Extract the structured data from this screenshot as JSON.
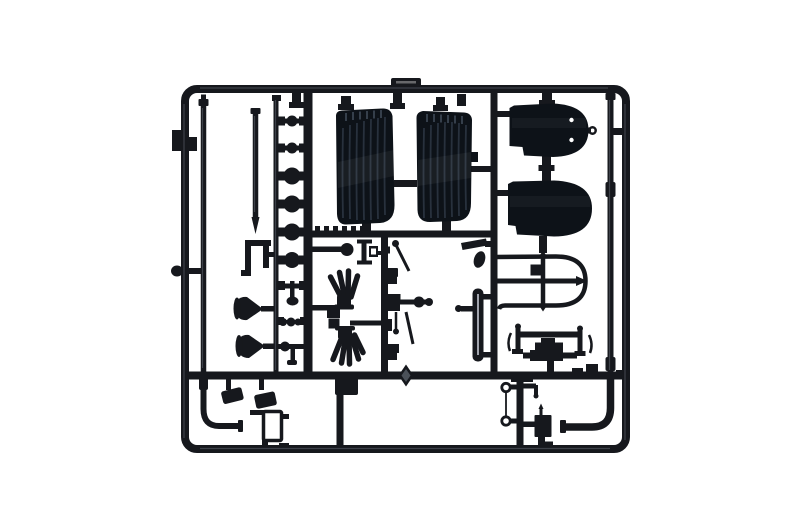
{
  "image": {
    "type": "product-photograph",
    "subject": "Injection-molded model kit sprue (parts tree) of black plastic parts on a white background",
    "orientation": "landscape",
    "background": "#ffffff"
  },
  "colors": {
    "plastic": "#16181d",
    "plastic_deep": "#0a0c10",
    "highlight": "#5d636e",
    "seat_body": "#0d1218",
    "seat_rib": "#2b3542",
    "seat_tick": "#434e5c",
    "strip_sheen": "#c2c7cf",
    "paper_white": "#ffffff",
    "bead_facet": "#4a5058"
  },
  "parts": [
    "sprue outer frame",
    "ribbed seat back left",
    "ribbed seat back right",
    "rounded seat pan upper",
    "rounded seat pan lower",
    "windscreen frame with cross bars",
    "front axle assembly",
    "exhaust manifold upper (fan of pipes)",
    "exhaust manifold lower (fan of pipes)",
    "air horn cone small",
    "air horn cone large",
    "column of round caps and knobs",
    "control lever linkages",
    "leaf spring strip",
    "foot pedal left",
    "foot pedal right",
    "L-bent exhaust pipe left",
    "L-bent exhaust pipe right",
    "long rod left",
    "long rod middle",
    "long rod right",
    "fuel pump box with pin",
    "brake line with two eyelets",
    "clamp bracket",
    "step bracket",
    "faceted rivet bead",
    "small rectangular frame part"
  ]
}
